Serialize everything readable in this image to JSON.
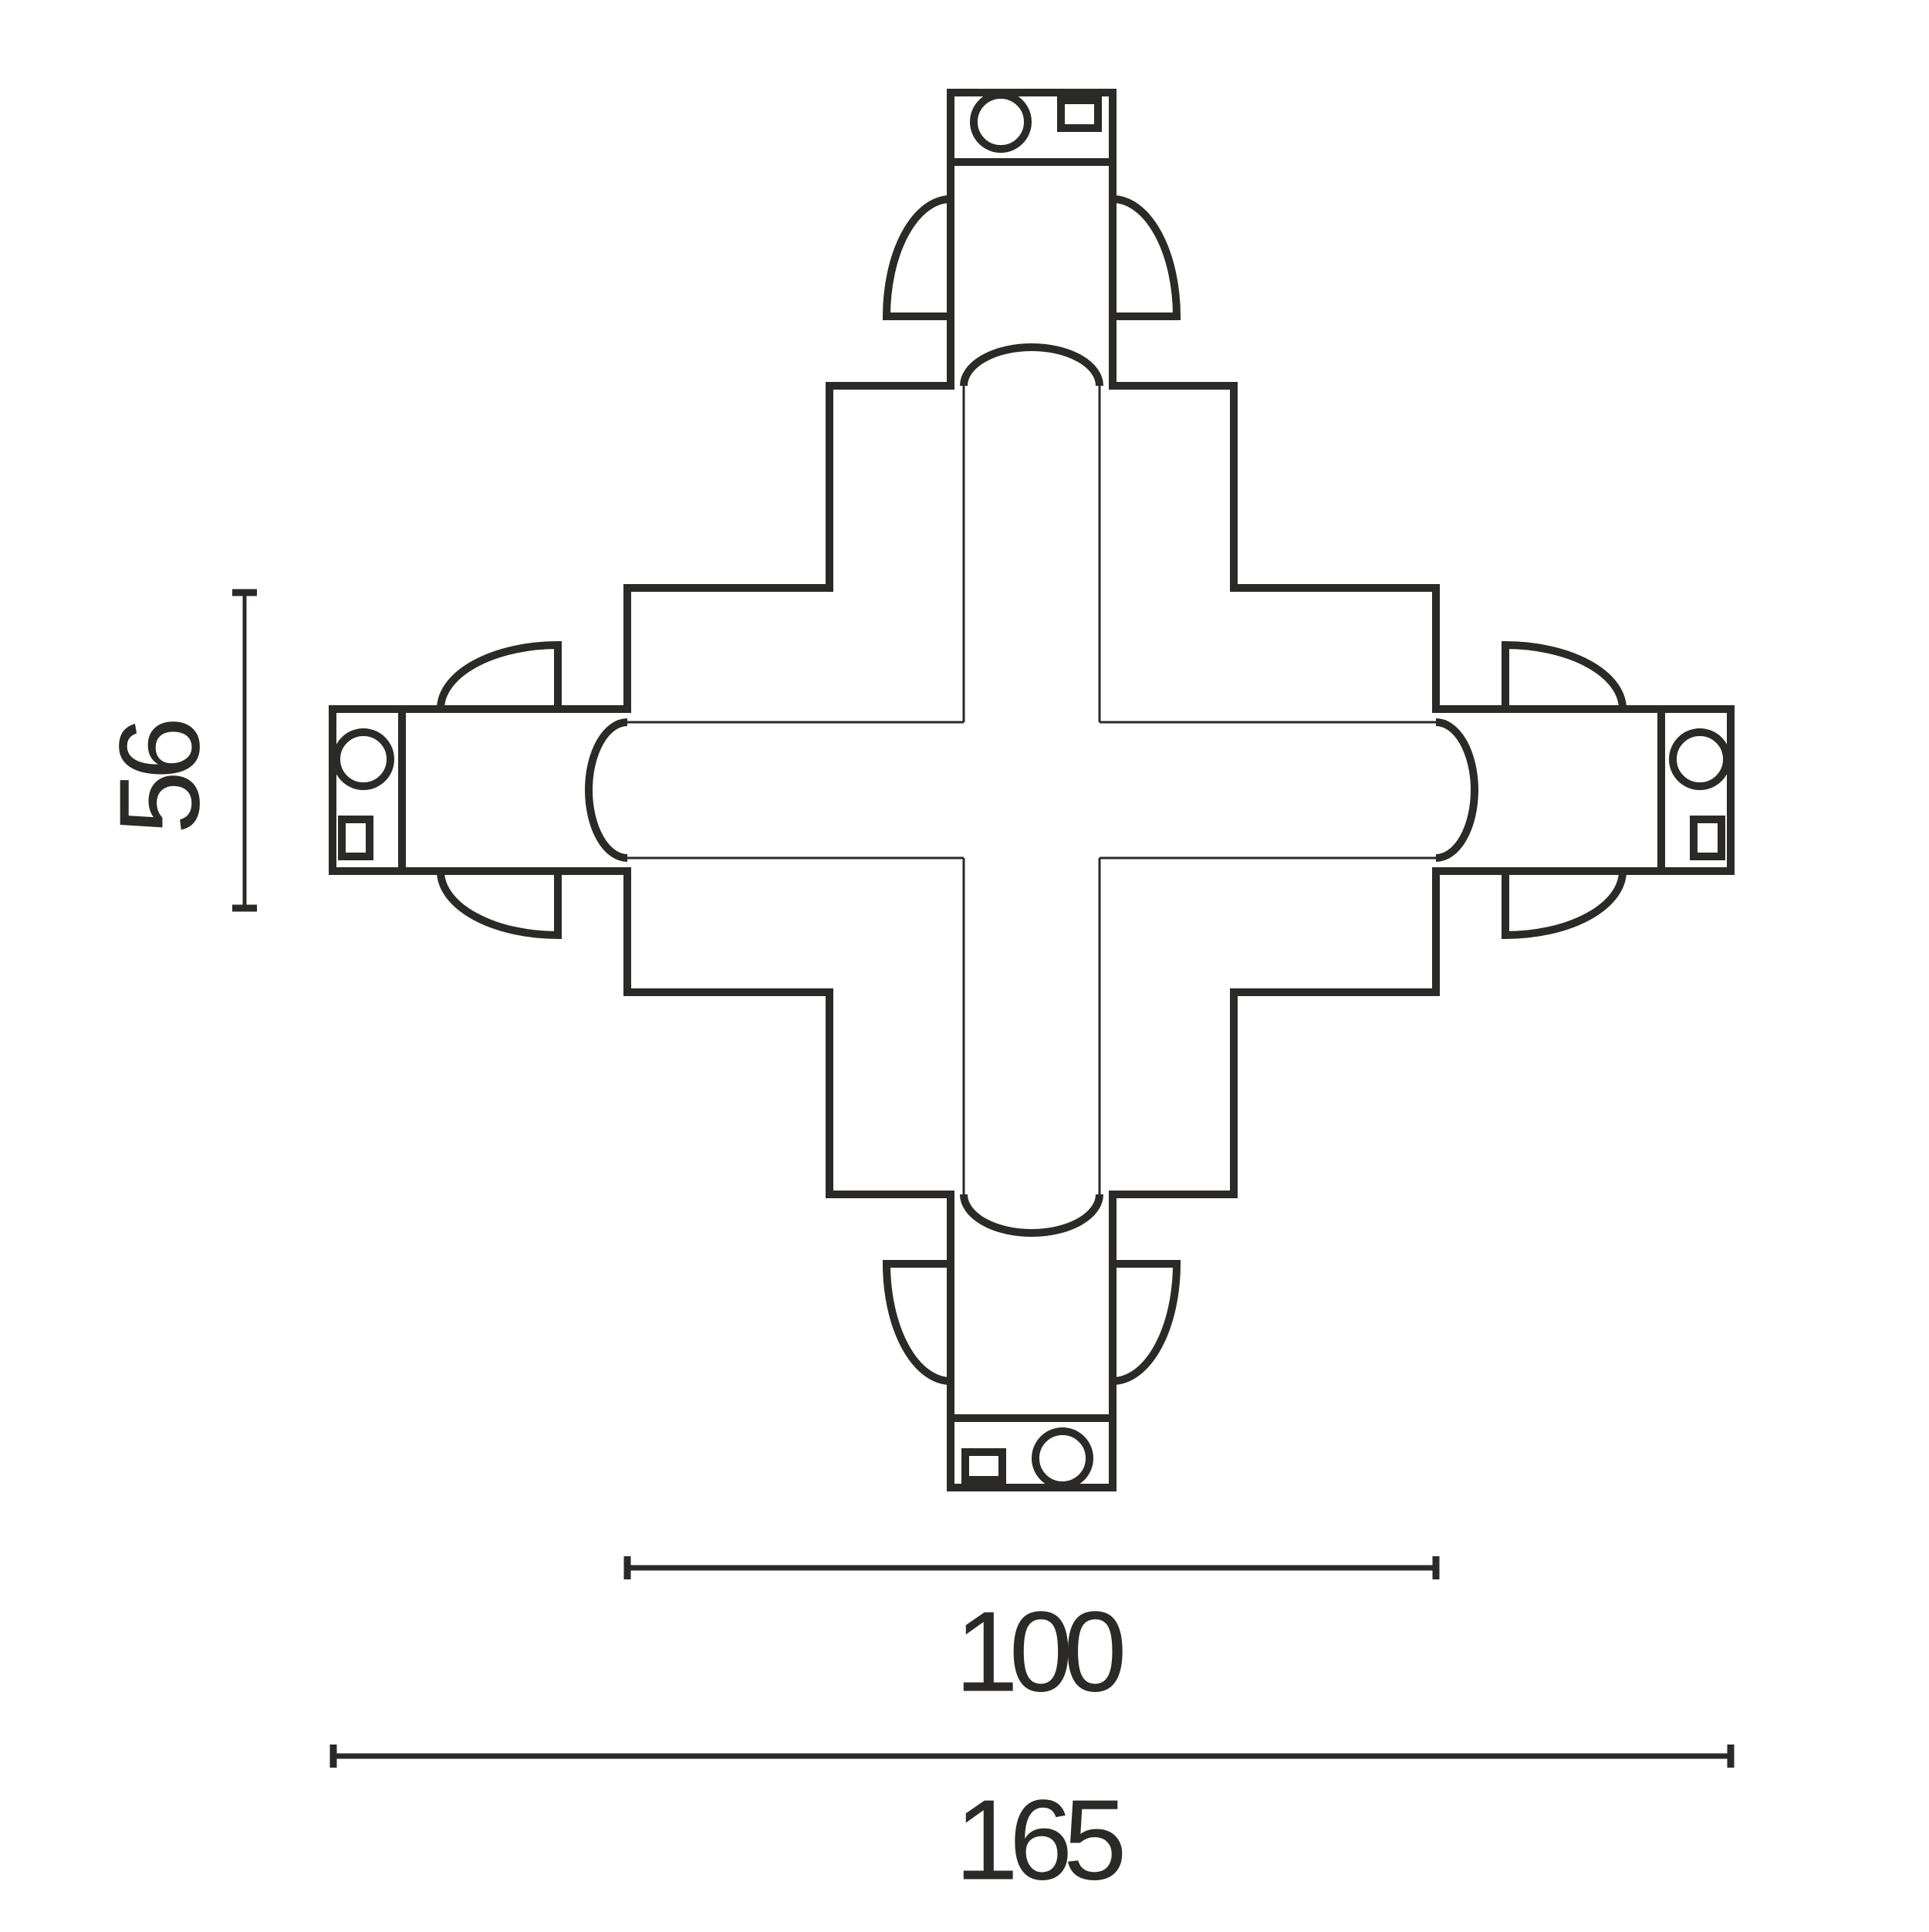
{
  "drawing": {
    "subject": "X cross track connector - dimensioned top view",
    "stroke_color": "#2b2a29",
    "background_color": "#ffffff",
    "dimension_labels": {
      "vertical": "56",
      "inner_horizontal": "100",
      "outer_horizontal": "165"
    }
  }
}
